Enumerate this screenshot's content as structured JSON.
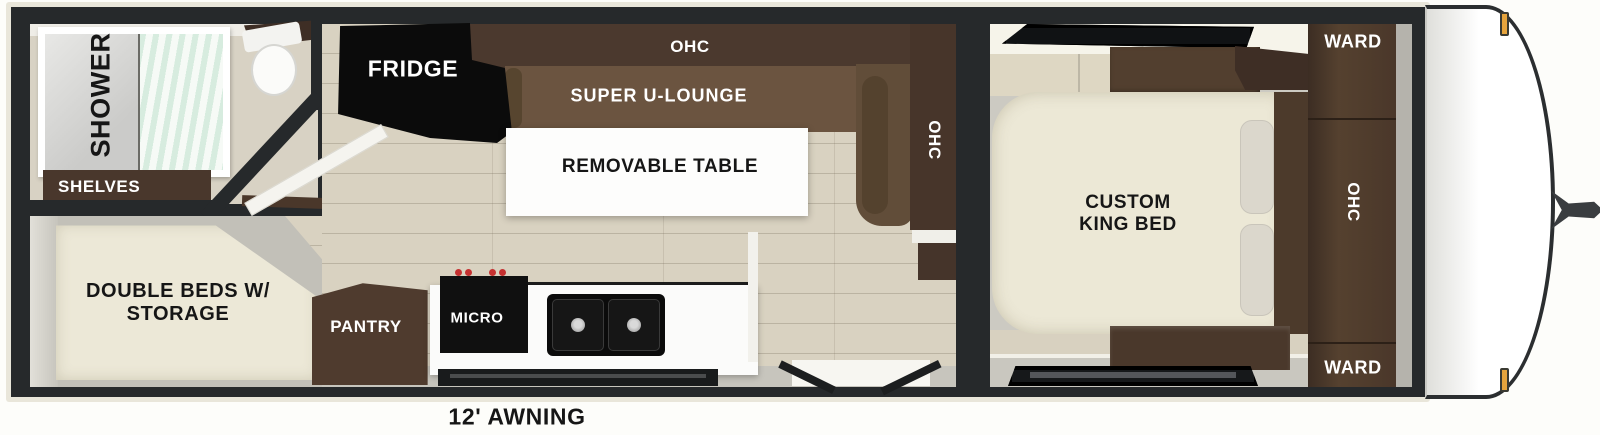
{
  "rooms": {
    "bathroom": {
      "shower": "SHOWER",
      "shelves": "SHELVES"
    },
    "bunk_room": {
      "double_beds": "DOUBLE BEDS W/ STORAGE"
    },
    "galley": {
      "fridge": "FRIDGE",
      "ohc": "OHC",
      "pantry": "PANTRY",
      "micro": "MICRO"
    },
    "lounge": {
      "name": "SUPER U-LOUNGE",
      "table": "REMOVABLE TABLE",
      "ohc_side": "OHC"
    },
    "bedroom": {
      "bed": "CUSTOM KING BED",
      "ward_top": "WARD",
      "ohc": "OHC",
      "ward_bottom": "WARD"
    }
  },
  "exterior": {
    "awning": "12' AWNING"
  },
  "colors": {
    "shell_outline": "#26292b",
    "trim": "#e9e6da",
    "floor_wood": "#d9d2c1",
    "floor_gray": "#c7c5bd",
    "cabinet_dark_brown": "#4a382c",
    "lounge_brown": "#6b5440",
    "bed_cream": "#ece8d6",
    "appliance_black": "#0c0c0c",
    "counter_white": "#fbfbfa",
    "shower_curtain_mint": "#dff0e8",
    "stove_knob_red": "#c53030",
    "marker_light_amber": "#e6a43d"
  }
}
